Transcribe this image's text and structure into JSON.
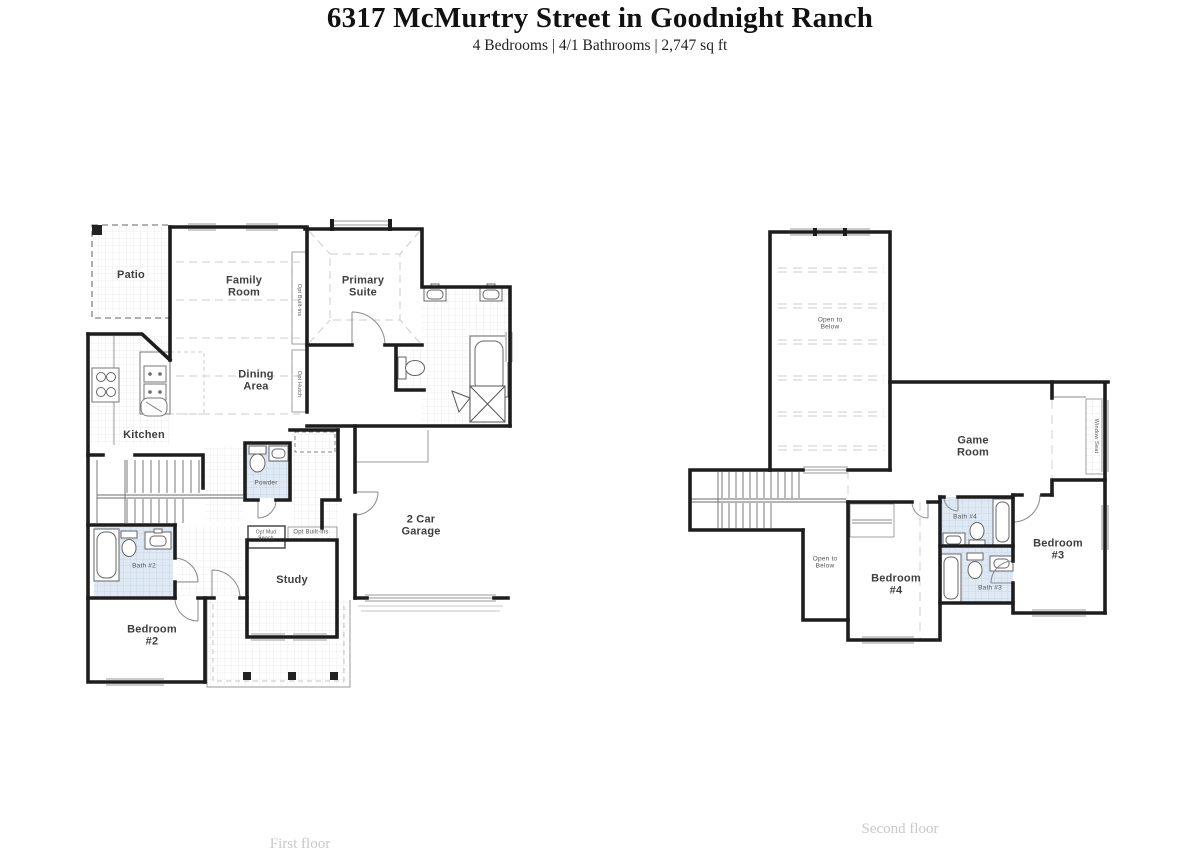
{
  "header": {
    "title": "6317 McMurtry Street in Goodnight Ranch",
    "subtitle": "4 Bedrooms | 4/1 Bathrooms | 2,747 sq ft"
  },
  "colors": {
    "wall": "#1d1d1d",
    "tile_blue": "#dfe9f4",
    "label": "#3e3e3e",
    "caption": "#c9c9c9"
  },
  "first_floor": {
    "caption": "First floor",
    "labels": [
      {
        "id": "patio",
        "text": "Patio",
        "x": 131,
        "y": 275,
        "size": 11
      },
      {
        "id": "family-room",
        "text": "Family\nRoom",
        "x": 244,
        "y": 287,
        "size": 11
      },
      {
        "id": "primary-suite",
        "text": "Primary\nSuite",
        "x": 363,
        "y": 287,
        "size": 11
      },
      {
        "id": "dining-area",
        "text": "Dining\nArea",
        "x": 256,
        "y": 381,
        "size": 11
      },
      {
        "id": "kitchen",
        "text": "Kitchen",
        "x": 144,
        "y": 435,
        "size": 11
      },
      {
        "id": "powder",
        "text": "Powder",
        "x": 266,
        "y": 483,
        "size": 6.5
      },
      {
        "id": "two-car-garage",
        "text": "2 Car\nGarage",
        "x": 421,
        "y": 526,
        "size": 11
      },
      {
        "id": "study",
        "text": "Study",
        "x": 292,
        "y": 580,
        "size": 11
      },
      {
        "id": "bath-2",
        "text": "Bath #2",
        "x": 144,
        "y": 566,
        "size": 6.5
      },
      {
        "id": "bedroom-2",
        "text": "Bedroom\n#2",
        "x": 152,
        "y": 636,
        "size": 11
      },
      {
        "id": "opt-built-ins-vertical",
        "text": "Opt Built-ins",
        "x": 299,
        "y": 300,
        "size": 5.5,
        "rotate": 90
      },
      {
        "id": "opt-hutch",
        "text": "Opt Hutch",
        "x": 299,
        "y": 384,
        "size": 5.5,
        "rotate": 90
      },
      {
        "id": "opt-mud-bench",
        "text": "Opt Mud\nBench",
        "x": 266,
        "y": 536,
        "size": 5
      },
      {
        "id": "opt-built-ins",
        "text": "Opt Built-ins",
        "x": 311,
        "y": 533,
        "size": 6
      }
    ]
  },
  "second_floor": {
    "caption": "Second floor",
    "labels": [
      {
        "id": "open-to-below-large",
        "text": "Open to\nBelow",
        "x": 830,
        "y": 324,
        "size": 6.5
      },
      {
        "id": "game-room",
        "text": "Game\nRoom",
        "x": 973,
        "y": 447,
        "size": 11
      },
      {
        "id": "window-seat",
        "text": "Window Seat",
        "x": 1096,
        "y": 436,
        "size": 5.5,
        "rotate": 90
      },
      {
        "id": "open-to-below-small",
        "text": "Open to\nBelow",
        "x": 825,
        "y": 563,
        "size": 6.5
      },
      {
        "id": "bedroom-4",
        "text": "Bedroom\n#4",
        "x": 896,
        "y": 585,
        "size": 11
      },
      {
        "id": "bath-4",
        "text": "Bath #4",
        "x": 965,
        "y": 517,
        "size": 6.5
      },
      {
        "id": "bath-3",
        "text": "Bath #3",
        "x": 990,
        "y": 588,
        "size": 6.5
      },
      {
        "id": "bedroom-3",
        "text": "Bedroom\n#3",
        "x": 1058,
        "y": 550,
        "size": 11
      }
    ]
  }
}
